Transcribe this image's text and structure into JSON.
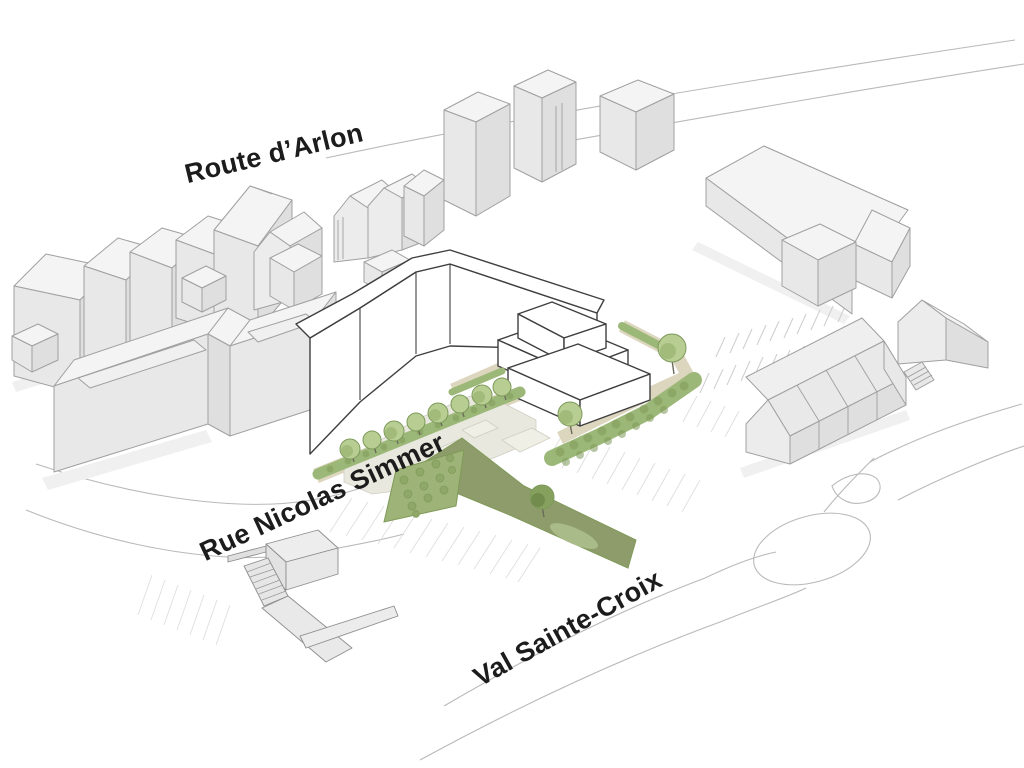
{
  "street_labels": {
    "arlon": "Route d’Arlon",
    "simmer": "Rue Nicolas Simmer",
    "val": "Val Sainte-Croix"
  },
  "palette": {
    "background": "#ffffff",
    "label_text": "#1c1c1c",
    "existing_wall": "#e8e8e8",
    "existing_wall_shaded": "#dfdfdf",
    "existing_roof": "#f4f4f4",
    "existing_outline": "#a0a0a0",
    "new_building_fill": "#ffffff",
    "new_building_outline": "#3f3f3f",
    "path_beige": "#ddd6bf",
    "courtyard_paving": "#e9e8df",
    "paving_light": "#f0efe6",
    "hedge_green": "#9cb878",
    "hedge_dark": "#7f9a58",
    "tree_crown": "#b7cd92",
    "tree_crown_shade": "#9cb674",
    "lawn_dark": "#8e9c6c",
    "lawn_light": "#aabb8a",
    "bush_green": "#9db377",
    "road_line": "#b9b9b9",
    "hatch_line": "#dcdcdc",
    "parking_line": "#cdcdcd",
    "shadow": "#f0f0f0"
  }
}
